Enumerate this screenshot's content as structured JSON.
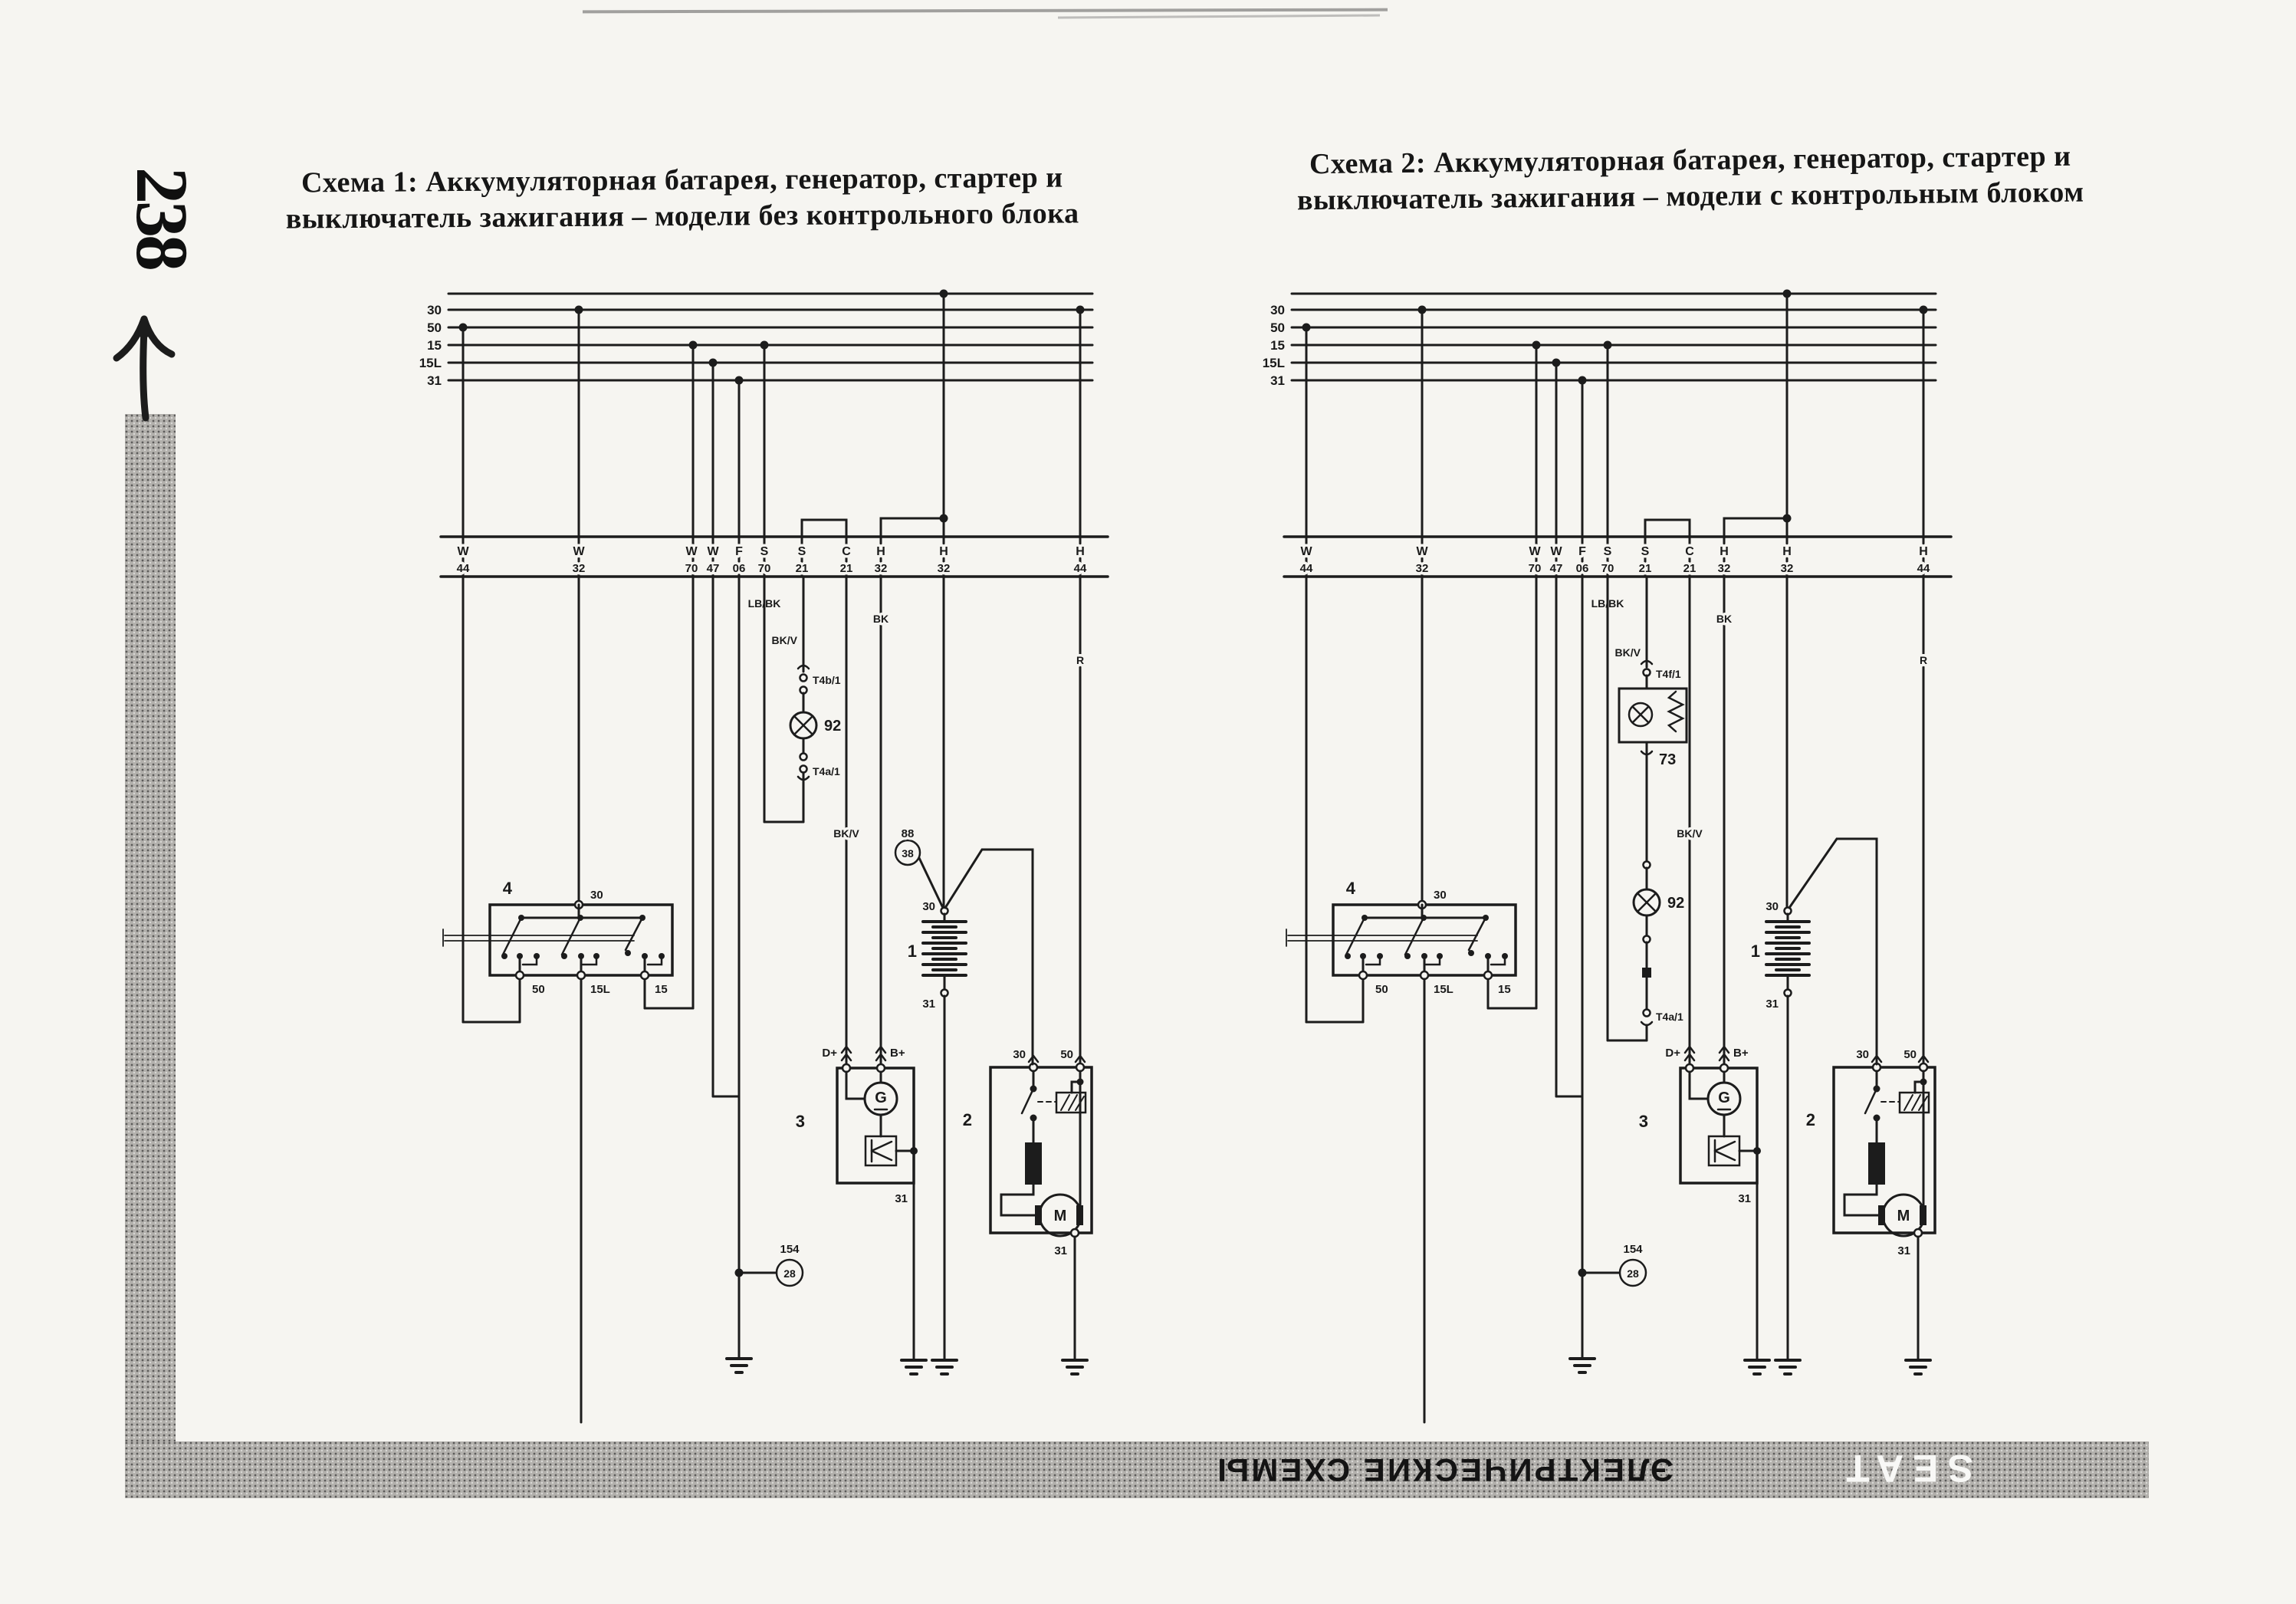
{
  "page": {
    "number": "238",
    "tab_text": "ЭЛЕКТРИЧЕСКИЕ СХЕМЫ",
    "brand_tab": "SEAT"
  },
  "titles": {
    "scheme1_line1": "Схема 1: Аккумуляторная батарея, генератор, стартер и",
    "scheme1_line2": "выключатель зажигания – модели без контрольного блока",
    "scheme2_line1": "Схема 2: Аккумуляторная батарея, генератор, стартер и",
    "scheme2_line2": "выключатель зажигания – модели с контрольным блоком"
  },
  "shared": {
    "bus_labels": [
      "30",
      "50",
      "15",
      "15L",
      "31"
    ],
    "terminals": [
      {
        "l": "W",
        "n": "44"
      },
      {
        "l": "W",
        "n": "32"
      },
      {
        "l": "W",
        "n": "70"
      },
      {
        "l": "W",
        "n": "47"
      },
      {
        "l": "F",
        "n": "06"
      },
      {
        "l": "S",
        "n": "70"
      },
      {
        "l": "S",
        "n": "21"
      },
      {
        "l": "C",
        "n": "21"
      },
      {
        "l": "H",
        "n": "32"
      },
      {
        "l": "H",
        "n": "32"
      },
      {
        "l": "H",
        "n": "44"
      }
    ],
    "wire_colors": {
      "lb_bk": "LB/BK",
      "bk_v": "BK/V",
      "bk": "BK",
      "r": "R"
    },
    "ignition_switch": {
      "id": "4",
      "t30": "30",
      "t50": "50",
      "t15l": "15L",
      "t15": "15"
    },
    "generator": {
      "id": "3",
      "dplus": "D+",
      "bplus": "B+",
      "g": "G",
      "t31": "31"
    },
    "starter": {
      "id": "2",
      "t30": "30",
      "t50": "50",
      "m": "M",
      "t31": "31"
    },
    "battery": {
      "id": "1",
      "t30": "30",
      "t31": "31"
    },
    "ground_point": {
      "id": "154",
      "code": "28"
    }
  },
  "diagram1": {
    "splice": {
      "id": "88",
      "code": "38"
    },
    "branch": {
      "wire": "BK/V",
      "conn_top": "T4b/1",
      "lamp": "92",
      "conn_bottom": "T4a/1"
    }
  },
  "diagram2": {
    "branch": {
      "wire": "BK/V",
      "conn_top": "T4f/1",
      "control_unit": "73",
      "lamp": "92",
      "conn_bottom": "T4a/1"
    }
  }
}
